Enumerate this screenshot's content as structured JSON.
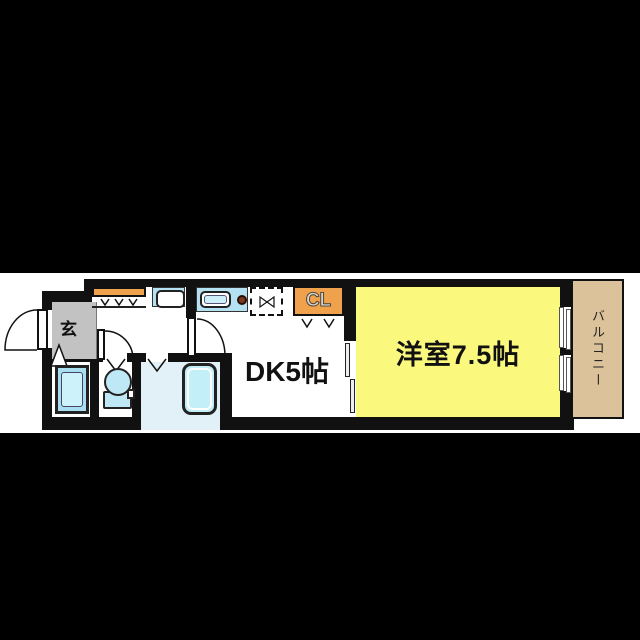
{
  "photo": {
    "description": "Japanese apartment 1DK floor plan photo, letterboxed",
    "letterbox_color": "#000000",
    "paper_color": "#FFFFFF"
  },
  "labels": {
    "entrance": "玄",
    "dining_kitchen": "DK5帖",
    "western_room": "洋室7.5帖",
    "closet": "CL",
    "balcony": "バルコニー"
  },
  "colors": {
    "wall": "#111111",
    "western_room_fill": "#FBF97D",
    "balcony_fill": "#DCC29A",
    "closet_fill": "#EFA14B",
    "shoebox_fill": "#EFA14B",
    "entrance_fill": "#C2C2C2",
    "fixture_panel_fill": "#B5E2F2",
    "fixture_fill": "#CDF0FA",
    "bath_floor_fill": "#E2F0F8",
    "burner_fill": "#7B3A1E",
    "closet_text": "#D9D3C9"
  }
}
